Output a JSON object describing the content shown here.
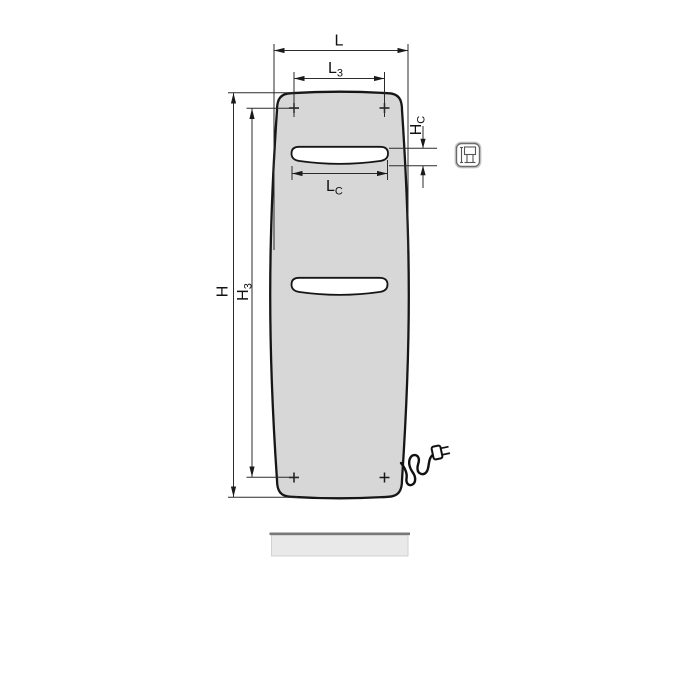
{
  "drawing": {
    "dimension_labels": {
      "overall_width": {
        "main": "L"
      },
      "mount_width": {
        "main": "L",
        "sub": "3"
      },
      "slot_width": {
        "main": "L",
        "sub": "C"
      },
      "overall_height": {
        "main": "H"
      },
      "mount_height": {
        "main": "H",
        "sub": "3"
      },
      "slot_height": {
        "main": "H",
        "sub": "C"
      }
    },
    "colors": {
      "panel_fill": "#d7d7d7",
      "slot_fill": "#ffffff",
      "floor_fill": "#e9e9e9",
      "floor_edge": "#787878",
      "line": "#1a1a1a"
    },
    "icons": {
      "connection_badge": "electric-connection-pictogram",
      "plug": "power-plug-icon",
      "mounting_marks": "cross-markers"
    }
  }
}
